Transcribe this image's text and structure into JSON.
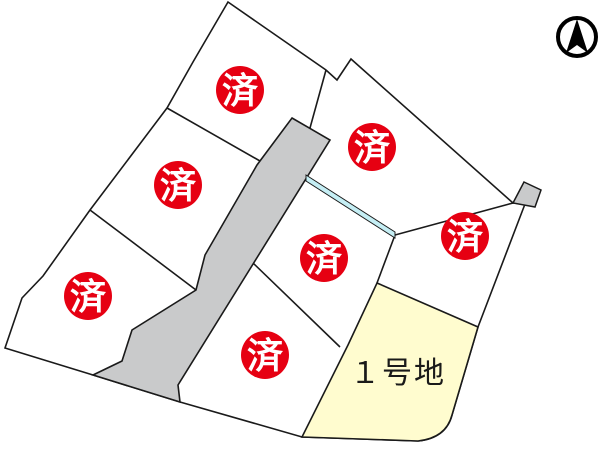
{
  "map_title": "subdivision-lot-map",
  "colors": {
    "background": "#ffffff",
    "boundary_line": "#1a1a1a",
    "road_fill": "#c9cacb",
    "waterway_fill": "#c5eef4",
    "available_lot_fill": "#fffccf",
    "sold_badge_bg": "#e60012",
    "sold_badge_text": "#ffffff",
    "north_arrow": "#000000"
  },
  "sold_badge": {
    "label": "済",
    "radius": 24,
    "font_size": 36
  },
  "sold_marks": [
    {
      "x": 240,
      "y": 90
    },
    {
      "x": 372,
      "y": 147
    },
    {
      "x": 178,
      "y": 185
    },
    {
      "x": 465,
      "y": 236
    },
    {
      "x": 324,
      "y": 258
    },
    {
      "x": 88,
      "y": 296
    },
    {
      "x": 265,
      "y": 355
    }
  ],
  "available_lot": {
    "label": "１号地",
    "label_x": 398,
    "label_y": 383,
    "font_size": 30
  },
  "north_arrow": {
    "name": "north-arrow",
    "cx": 577,
    "cy": 37,
    "r": 19
  }
}
